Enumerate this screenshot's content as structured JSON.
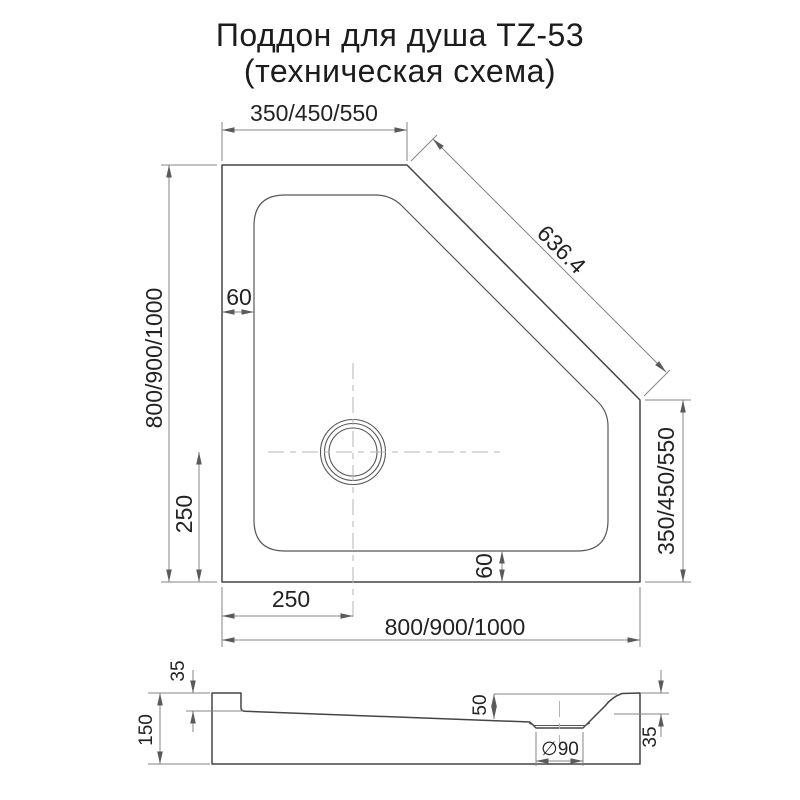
{
  "title": {
    "line1": "Поддон для душа TZ-53",
    "line2": "(техническая схема)"
  },
  "plan": {
    "width_top": "350/450/550",
    "diagonal": "636.4",
    "height_left": "800/900/1000",
    "height_right": "350/450/550",
    "width_bottom": "800/900/1000",
    "wall_top": "60",
    "wall_bottom": "60",
    "drain_offset_left": "250",
    "drain_offset_bottom": "250"
  },
  "section": {
    "rim_left": "35",
    "height": "150",
    "depth": "50",
    "drain_diameter": "∅90",
    "rim_right": "35"
  }
}
